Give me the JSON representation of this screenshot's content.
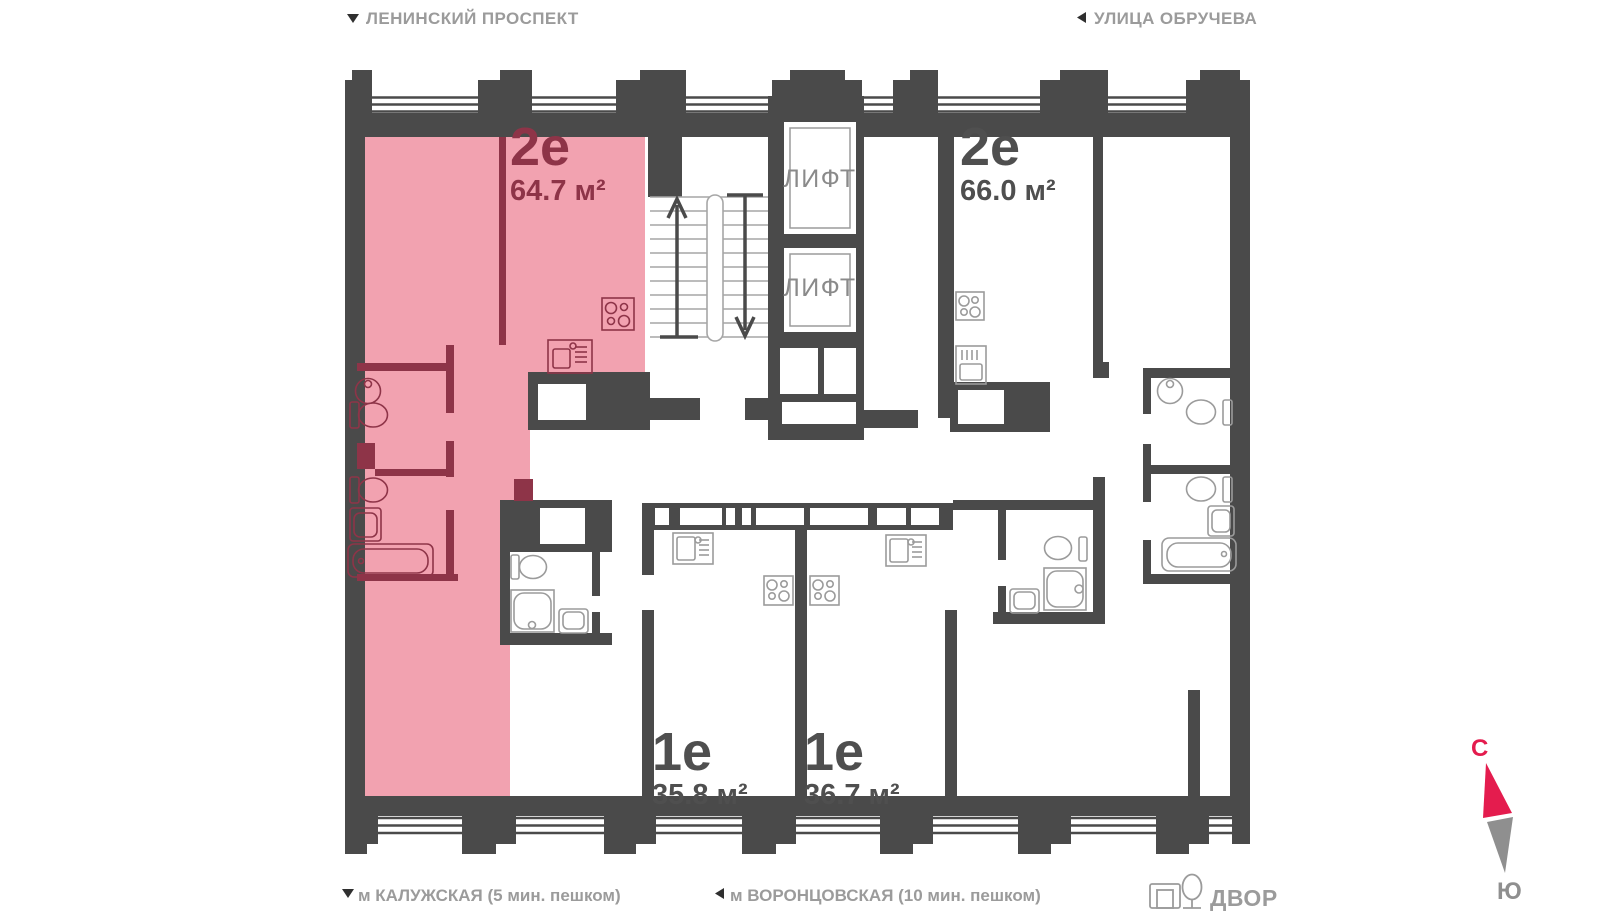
{
  "header": {
    "left_street": "ЛЕНИНСКИЙ ПРОСПЕКТ",
    "right_street": "УЛИЦА ОБРУЧЕВА"
  },
  "footer": {
    "left_metro": "м КАЛУЖСКАЯ (5 мин. пешком)",
    "center_metro": "м ВОРОНЦОВСКАЯ  (10 мин. пешком)",
    "yard": "ДВОР"
  },
  "compass": {
    "north": "С",
    "south": "Ю"
  },
  "elevator_label": "ЛИФТ",
  "apartments": [
    {
      "id": "apt-64",
      "type": "2е",
      "area": "64.7 м²",
      "highlighted": true
    },
    {
      "id": "apt-66",
      "type": "2е",
      "area": "66.0 м²",
      "highlighted": false
    },
    {
      "id": "apt-35",
      "type": "1е",
      "area": "35.8 м²",
      "highlighted": false
    },
    {
      "id": "apt-36",
      "type": "1е",
      "area": "36.7 м²",
      "highlighted": false
    }
  ],
  "colors": {
    "wall": "#4A4A4A",
    "highlight_fill": "#F2A2B0",
    "highlight_wall": "#8E3448",
    "label_dark": "#4F4F4F",
    "muted_text": "#9B9B9B",
    "fixture": "#9B9B9B",
    "tread": "#A6A6A6",
    "arrow_dark": "#2F2F2F",
    "compass_north": "#E41C4E",
    "compass_south": "#8F8F8F"
  }
}
